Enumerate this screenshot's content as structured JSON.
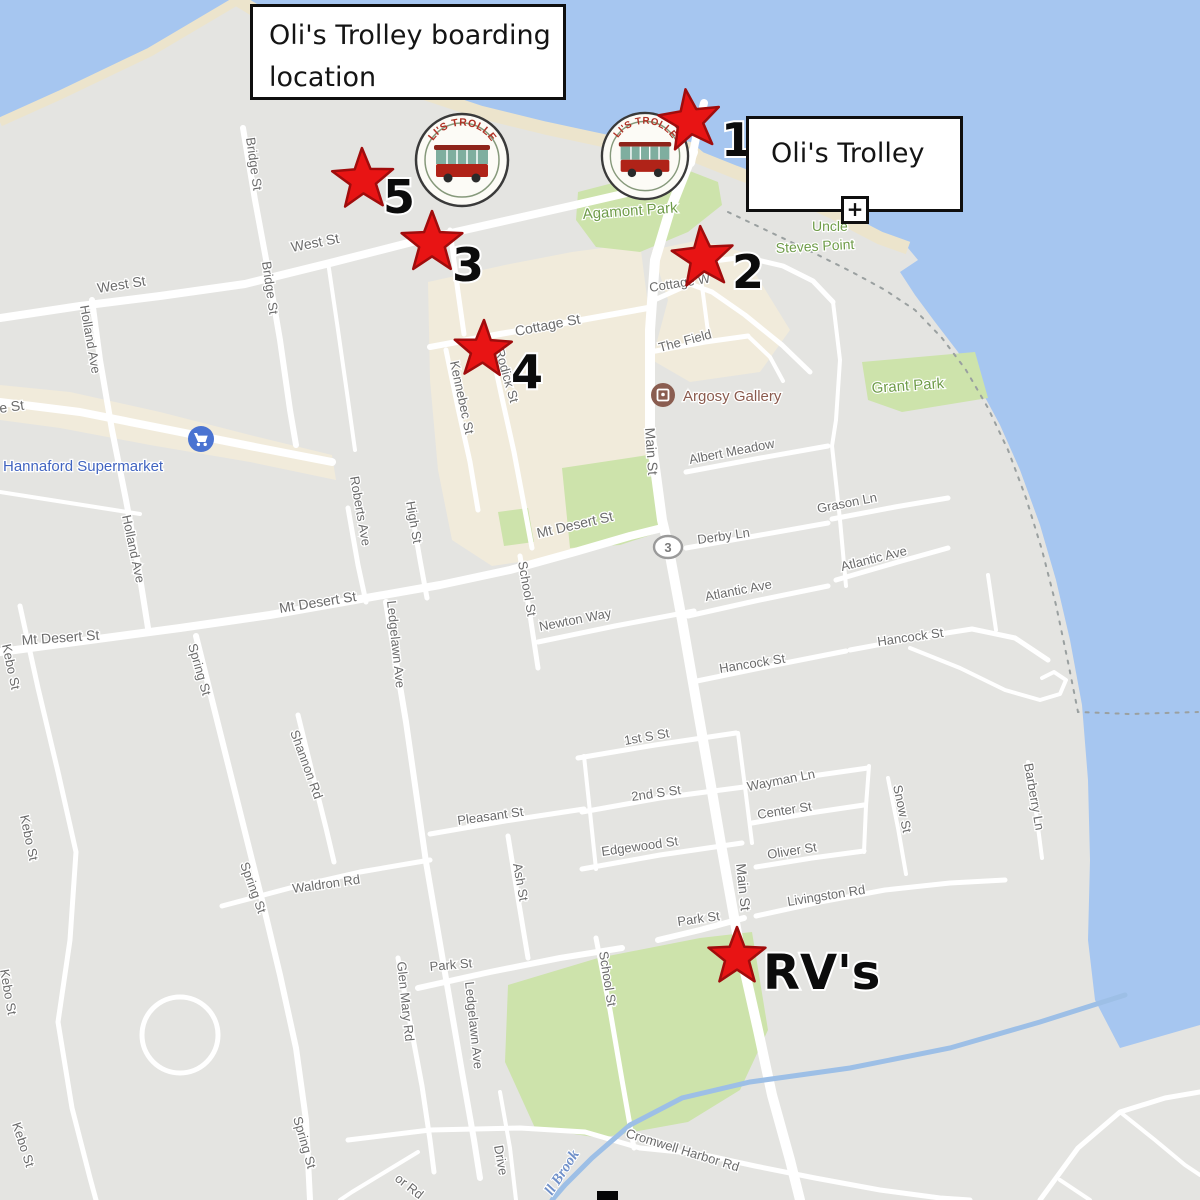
{
  "callouts": {
    "boarding": {
      "line1": "Oli's Trolley boarding",
      "line2": "location"
    },
    "trolley": {
      "label": "Oli's Trolley"
    },
    "plus": "+"
  },
  "logo": {
    "arc": "OLI'S TROLLEY"
  },
  "markers": {
    "stops": [
      {
        "num": "1",
        "sx": 690,
        "sy": 121,
        "nx": 737,
        "ny": 156,
        "R": 32,
        "rot": -98,
        "fs": 46
      },
      {
        "num": "2",
        "sx": 703,
        "sy": 258,
        "nx": 748,
        "ny": 288,
        "R": 32,
        "rot": -95,
        "fs": 46
      },
      {
        "num": "3",
        "sx": 432,
        "sy": 243,
        "nx": 468,
        "ny": 281,
        "R": 32,
        "rot": -90,
        "fs": 46
      },
      {
        "num": "4",
        "sx": 483,
        "sy": 350,
        "nx": 527,
        "ny": 388,
        "R": 30,
        "rot": -88,
        "fs": 46
      },
      {
        "num": "5",
        "sx": 363,
        "sy": 180,
        "nx": 399,
        "ny": 213,
        "R": 32,
        "rot": -92,
        "fs": 46
      }
    ],
    "rv": {
      "label": "RV's",
      "sx": 737,
      "sy": 957,
      "tx": 763,
      "ty": 989,
      "R": 30,
      "rot": -90,
      "fs": 48
    }
  },
  "map": {
    "route_shield": "3",
    "colors": {
      "water": "#a6c6f0",
      "land": "#e4e4e1",
      "park": "#cde3ab",
      "sand": "#ece4cc",
      "district": "#f1ebdb",
      "road": "#ffffff",
      "stream": "#9dbfe6",
      "street_label": "#6b6b6b",
      "park_label": "#6f9c49",
      "poi_blue": "#4164c0",
      "poi_brown": "#8a5a4d",
      "brook_blue": "#7191c9",
      "star_fill": "#e81414",
      "star_stroke": "#a00c0c"
    },
    "street_labels": [
      {
        "t": "West St",
        "x": 98,
        "y": 293,
        "r": -9,
        "s": 14
      },
      {
        "t": "West St",
        "x": 292,
        "y": 252,
        "r": -11,
        "s": 14
      },
      {
        "t": "Bridge St",
        "x": 246,
        "y": 138,
        "r": 82,
        "s": 13
      },
      {
        "t": "Bridge St",
        "x": 262,
        "y": 262,
        "r": 82,
        "s": 13
      },
      {
        "t": "Holland Ave",
        "x": 80,
        "y": 306,
        "r": 80,
        "s": 13
      },
      {
        "t": "Holland Ave",
        "x": 122,
        "y": 516,
        "r": 78,
        "s": 13
      },
      {
        "t": "e St",
        "x": 0,
        "y": 413,
        "r": -8,
        "s": 14
      },
      {
        "t": "Cottage St",
        "x": 516,
        "y": 336,
        "r": -11,
        "s": 14
      },
      {
        "t": "Cottage W",
        "x": 650,
        "y": 292,
        "r": -9,
        "s": 13
      },
      {
        "t": "Kennebec St",
        "x": 450,
        "y": 362,
        "r": 78,
        "s": 13
      },
      {
        "t": "Rodick St",
        "x": 495,
        "y": 350,
        "r": 74,
        "s": 13
      },
      {
        "t": "Main St",
        "x": 645,
        "y": 428,
        "r": 86,
        "s": 14
      },
      {
        "t": "Main St",
        "x": 736,
        "y": 864,
        "r": 84,
        "s": 14
      },
      {
        "t": "Mt Desert St",
        "x": 22,
        "y": 645,
        "r": -4,
        "s": 14
      },
      {
        "t": "Mt Desert St",
        "x": 280,
        "y": 613,
        "r": -9,
        "s": 14
      },
      {
        "t": "Mt Desert St",
        "x": 538,
        "y": 538,
        "r": -13,
        "s": 14
      },
      {
        "t": "Derby Ln",
        "x": 698,
        "y": 544,
        "r": -8,
        "s": 13
      },
      {
        "t": "Grason Ln",
        "x": 818,
        "y": 513,
        "r": -11,
        "s": 13
      },
      {
        "t": "Albert Meadow",
        "x": 690,
        "y": 464,
        "r": -11,
        "s": 13
      },
      {
        "t": "Atlantic Ave",
        "x": 706,
        "y": 601,
        "r": -11,
        "s": 13
      },
      {
        "t": "Atlantic Ave",
        "x": 842,
        "y": 571,
        "r": -14,
        "s": 13
      },
      {
        "t": "Newton Way",
        "x": 540,
        "y": 631,
        "r": -11,
        "s": 13
      },
      {
        "t": "Hancock St",
        "x": 720,
        "y": 673,
        "r": -9,
        "s": 13
      },
      {
        "t": "Hancock St",
        "x": 878,
        "y": 646,
        "r": -8,
        "s": 13
      },
      {
        "t": "School St",
        "x": 518,
        "y": 562,
        "r": 80,
        "s": 13
      },
      {
        "t": "School St",
        "x": 599,
        "y": 952,
        "r": 81,
        "s": 13
      },
      {
        "t": "Roberts Ave",
        "x": 350,
        "y": 477,
        "r": 80,
        "s": 13
      },
      {
        "t": "High St",
        "x": 406,
        "y": 502,
        "r": 80,
        "s": 13
      },
      {
        "t": "Ledgelawn Ave",
        "x": 387,
        "y": 601,
        "r": 84,
        "s": 13
      },
      {
        "t": "Ledgelawn Ave",
        "x": 465,
        "y": 982,
        "r": 84,
        "s": 13
      },
      {
        "t": "Glen Mary Rd",
        "x": 397,
        "y": 962,
        "r": 84,
        "s": 13
      },
      {
        "t": "Spring St",
        "x": 188,
        "y": 645,
        "r": 74,
        "s": 13
      },
      {
        "t": "Spring St",
        "x": 240,
        "y": 864,
        "r": 70,
        "s": 13
      },
      {
        "t": "Spring St",
        "x": 293,
        "y": 1118,
        "r": 74,
        "s": 13
      },
      {
        "t": "Shannon Rd",
        "x": 290,
        "y": 732,
        "r": 70,
        "s": 13
      },
      {
        "t": "Kebo St",
        "x": 2,
        "y": 645,
        "r": 78,
        "s": 13
      },
      {
        "t": "Kebo St",
        "x": 20,
        "y": 816,
        "r": 78,
        "s": 13
      },
      {
        "t": "Kebo St",
        "x": 0,
        "y": 970,
        "r": 80,
        "s": 13
      },
      {
        "t": "Kebo St",
        "x": 12,
        "y": 1124,
        "r": 72,
        "s": 13
      },
      {
        "t": "Waldron Rd",
        "x": 293,
        "y": 893,
        "r": -8,
        "s": 13
      },
      {
        "t": "Pleasant St",
        "x": 458,
        "y": 825,
        "r": -8,
        "s": 13
      },
      {
        "t": "1st S St",
        "x": 625,
        "y": 745,
        "r": -10,
        "s": 13
      },
      {
        "t": "2nd S St",
        "x": 632,
        "y": 801,
        "r": -8,
        "s": 13
      },
      {
        "t": "Wayman Ln",
        "x": 748,
        "y": 791,
        "r": -11,
        "s": 13
      },
      {
        "t": "Center St",
        "x": 758,
        "y": 819,
        "r": -9,
        "s": 13
      },
      {
        "t": "Edgewood St",
        "x": 602,
        "y": 856,
        "r": -8,
        "s": 13
      },
      {
        "t": "Oliver St",
        "x": 768,
        "y": 859,
        "r": -9,
        "s": 13
      },
      {
        "t": "Ash St",
        "x": 513,
        "y": 864,
        "r": 80,
        "s": 13
      },
      {
        "t": "Snow St",
        "x": 893,
        "y": 786,
        "r": 78,
        "s": 13
      },
      {
        "t": "Barberry Ln",
        "x": 1024,
        "y": 764,
        "r": 80,
        "s": 13
      },
      {
        "t": "Park St",
        "x": 430,
        "y": 971,
        "r": -5,
        "s": 13
      },
      {
        "t": "Park St",
        "x": 678,
        "y": 926,
        "r": -8,
        "s": 13
      },
      {
        "t": "Livingston Rd",
        "x": 788,
        "y": 906,
        "r": -9,
        "s": 13
      },
      {
        "t": "Cromwell Harbor Rd",
        "x": 625,
        "y": 1137,
        "r": 17,
        "s": 13
      },
      {
        "t": "Drive",
        "x": 494,
        "y": 1146,
        "r": 80,
        "s": 13
      },
      {
        "t": "or Rd",
        "x": 394,
        "y": 1180,
        "r": 38,
        "s": 13
      },
      {
        "t": "The Field",
        "x": 660,
        "y": 352,
        "r": -15,
        "s": 13
      }
    ],
    "park_labels": [
      {
        "t": "Agamont Park",
        "x": 583,
        "y": 219,
        "r": -4,
        "s": 15
      },
      {
        "t": "Uncle",
        "x": 812,
        "y": 231,
        "r": 0,
        "s": 14
      },
      {
        "t": "Steves Point",
        "x": 776,
        "y": 253,
        "r": -3,
        "s": 14
      },
      {
        "t": "Grant Park",
        "x": 872,
        "y": 393,
        "r": -4,
        "s": 15
      }
    ],
    "poi_labels": [
      {
        "t": "Hannaford Supermarket",
        "x": 3,
        "y": 471,
        "r": 0,
        "s": 15,
        "c": "#4164c0"
      },
      {
        "t": "Argosy Gallery",
        "x": 683,
        "y": 401,
        "r": 0,
        "s": 15,
        "c": "#8a5a4d"
      }
    ],
    "water_labels": [
      {
        "t": "ll Brook",
        "x": 552,
        "y": 1196,
        "r": -57,
        "s": 15,
        "c": "#7191c9"
      }
    ]
  }
}
